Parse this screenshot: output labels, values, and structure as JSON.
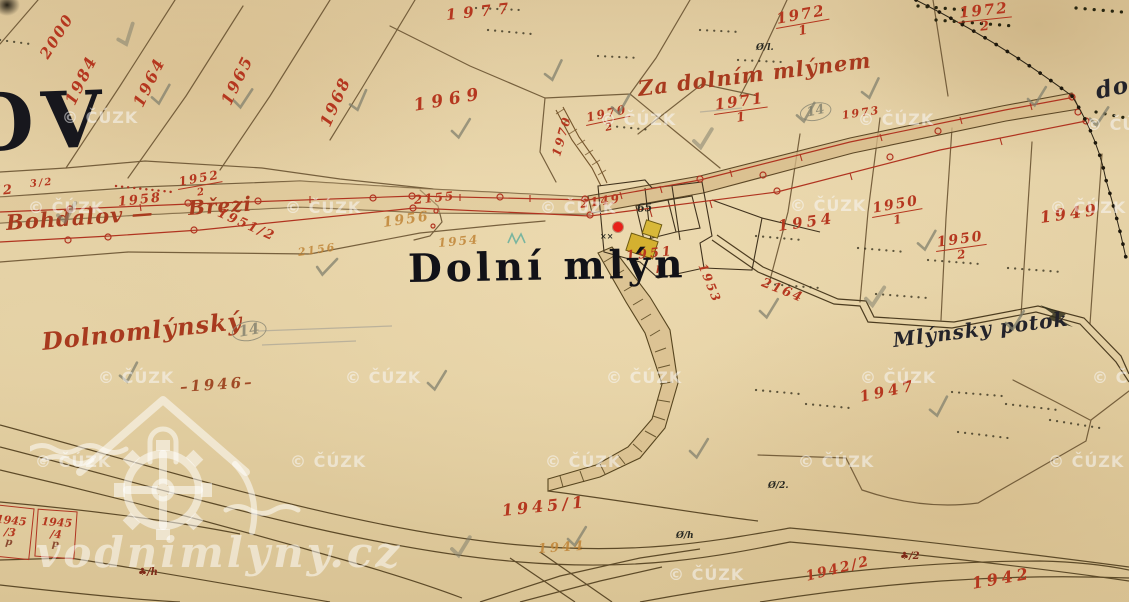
{
  "viewer": {
    "type": "historic-cadastral-map",
    "marker": {
      "x": 613,
      "y": 222,
      "color": "#e8211a"
    }
  },
  "watermark": {
    "text": "© ČÚZK",
    "site_text": "vodnimlyny.cz",
    "positions": [
      [
        62,
        108
      ],
      [
        600,
        110
      ],
      [
        858,
        110
      ],
      [
        1086,
        115
      ],
      [
        28,
        198
      ],
      [
        285,
        198
      ],
      [
        540,
        198
      ],
      [
        790,
        196
      ],
      [
        1050,
        198
      ],
      [
        98,
        368
      ],
      [
        345,
        368
      ],
      [
        606,
        368
      ],
      [
        860,
        368
      ],
      [
        1092,
        368
      ],
      [
        35,
        452
      ],
      [
        290,
        452
      ],
      [
        545,
        452
      ],
      [
        798,
        452
      ],
      [
        1048,
        452
      ],
      [
        668,
        565
      ]
    ]
  },
  "labels": [
    {
      "t": "2000",
      "x": 44,
      "y": 50,
      "r": -58,
      "c": "red",
      "s": 15
    },
    {
      "t": "1984",
      "x": 70,
      "y": 96,
      "r": -64,
      "c": "red",
      "s": 16
    },
    {
      "t": "1964",
      "x": 138,
      "y": 98,
      "r": -64,
      "c": "red",
      "s": 16
    },
    {
      "t": "1965",
      "x": 226,
      "y": 96,
      "r": -64,
      "c": "red",
      "s": 16
    },
    {
      "t": "1968",
      "x": 325,
      "y": 118,
      "r": -66,
      "c": "red",
      "s": 16
    },
    {
      "t": "1977",
      "x": 446,
      "y": 8,
      "r": -6,
      "c": "red",
      "s": 15,
      "sp": 7
    },
    {
      "t": "1969",
      "x": 414,
      "y": 98,
      "r": -10,
      "c": "red",
      "s": 17,
      "sp": 6
    },
    {
      "t": "1970",
      "x": 556,
      "y": 150,
      "r": -74,
      "c": "red",
      "s": 12
    },
    {
      "t": "1970",
      "d": "2",
      "x": 586,
      "y": 112,
      "r": -12,
      "c": "red",
      "s": 12
    },
    {
      "t": "1971",
      "d": "1",
      "x": 714,
      "y": 98,
      "r": -8,
      "c": "red",
      "s": 15
    },
    {
      "t": "1972",
      "d": "1",
      "x": 776,
      "y": 12,
      "r": -10,
      "c": "red",
      "s": 15
    },
    {
      "t": "1972",
      "d": "2",
      "x": 958,
      "y": 6,
      "r": -6,
      "c": "red",
      "s": 15
    },
    {
      "t": "1973",
      "x": 842,
      "y": 110,
      "r": -8,
      "c": "red",
      "s": 11
    },
    {
      "t": "2155",
      "x": 414,
      "y": 194,
      "r": -6,
      "c": "red",
      "s": 12
    },
    {
      "t": "1952",
      "d": "2",
      "x": 178,
      "y": 176,
      "r": -10,
      "c": "red",
      "s": 12
    },
    {
      "t": "1958",
      "x": 118,
      "y": 196,
      "r": -6,
      "c": "red",
      "s": 13
    },
    {
      "t": "1962",
      "x": -30,
      "y": 188,
      "r": -6,
      "c": "red",
      "s": 13
    },
    {
      "t": "3/2",
      "x": 30,
      "y": 180,
      "r": -6,
      "c": "red",
      "s": 10
    },
    {
      "t": "Bohdalov —",
      "x": 6,
      "y": 212,
      "r": -4,
      "c": "cursive",
      "s": 21
    },
    {
      "t": "Březi",
      "x": 188,
      "y": 198,
      "r": -4,
      "c": "cursive",
      "s": 20
    },
    {
      "t": "1951/2",
      "x": 218,
      "y": 206,
      "r": 24,
      "c": "red",
      "s": 13
    },
    {
      "t": "2149",
      "x": 580,
      "y": 198,
      "r": -8,
      "c": "red",
      "s": 12
    },
    {
      "t": "65",
      "x": 637,
      "y": 203,
      "r": -5,
      "c": "black-small",
      "s": 11
    },
    {
      "t": "××",
      "x": 600,
      "y": 232,
      "r": 0,
      "c": "black-small",
      "s": 8
    },
    {
      "t": "1956",
      "x": 383,
      "y": 216,
      "r": -8,
      "c": "orange",
      "s": 14
    },
    {
      "t": "1954",
      "x": 438,
      "y": 237,
      "r": -5,
      "c": "orange",
      "s": 12
    },
    {
      "t": "2156",
      "x": 298,
      "y": 247,
      "r": -8,
      "c": "orange",
      "s": 11
    },
    {
      "t": "1951",
      "x": 626,
      "y": 250,
      "r": -6,
      "c": "red",
      "s": 13,
      "sp": 3
    },
    {
      "t": "p",
      "x": 656,
      "y": 264,
      "r": 0,
      "c": "red",
      "s": 10
    },
    {
      "t": "1953",
      "x": 702,
      "y": 258,
      "r": 68,
      "c": "red",
      "s": 12
    },
    {
      "t": "2164",
      "x": 762,
      "y": 276,
      "r": 22,
      "c": "red",
      "s": 13
    },
    {
      "t": "1954",
      "x": 778,
      "y": 219,
      "r": -8,
      "c": "red",
      "s": 15,
      "sp": 4
    },
    {
      "t": "1950",
      "d": "1",
      "x": 872,
      "y": 202,
      "r": -10,
      "c": "red",
      "s": 14
    },
    {
      "t": "1950",
      "d": "2",
      "x": 936,
      "y": 236,
      "r": -8,
      "c": "red",
      "s": 14
    },
    {
      "t": "1949",
      "x": 1040,
      "y": 210,
      "r": -8,
      "c": "red",
      "s": 16,
      "sp": 4
    },
    {
      "t": "Za dolním mlýnem",
      "x": 638,
      "y": 78,
      "r": -7,
      "c": "cursive",
      "s": 21
    },
    {
      "t": "do",
      "x": 1096,
      "y": 80,
      "r": -12,
      "c": "black-italic",
      "s": 23
    },
    {
      "t": "Mlýnsky potok",
      "x": 893,
      "y": 330,
      "r": -7,
      "c": "black-italic",
      "s": 20
    },
    {
      "t": "OV",
      "x": -34,
      "y": 86,
      "r": -2,
      "c": "placename",
      "s": 78
    },
    {
      "t": "Dolní mlýn",
      "x": 408,
      "y": 250,
      "r": -1,
      "c": "title",
      "s": 39
    },
    {
      "t": "Dolnomlýnský",
      "x": 42,
      "y": 330,
      "r": -6,
      "c": "cursive",
      "s": 24
    },
    {
      "t": "14",
      "x": 232,
      "y": 324,
      "r": -10,
      "c": "pencil-circle",
      "s": 15
    },
    {
      "t": "14",
      "x": 800,
      "y": 106,
      "r": -12,
      "c": "pencil-circle",
      "s": 13
    },
    {
      "t": "–1946–",
      "x": 180,
      "y": 380,
      "r": -4,
      "c": "redbrown",
      "s": 15,
      "sp": 3
    },
    {
      "t": "1947",
      "x": 860,
      "y": 390,
      "r": -12,
      "c": "red",
      "s": 15,
      "sp": 4
    },
    {
      "t": "1945/1",
      "x": 502,
      "y": 503,
      "r": -6,
      "c": "red",
      "s": 16,
      "sp": 4
    },
    {
      "t": "1944",
      "x": 538,
      "y": 543,
      "r": -4,
      "c": "orange",
      "s": 13,
      "sp": 3
    },
    {
      "t": "1942/2",
      "x": 806,
      "y": 570,
      "r": -14,
      "c": "red",
      "s": 14,
      "sp": 2
    },
    {
      "t": "1942",
      "x": 972,
      "y": 576,
      "r": -10,
      "c": "red",
      "s": 16,
      "sp": 4
    },
    {
      "t": "Ø/2.",
      "x": 768,
      "y": 482,
      "r": 0,
      "c": "black-small",
      "s": 9
    },
    {
      "t": "Ø/h",
      "x": 676,
      "y": 532,
      "r": 0,
      "c": "black-small",
      "s": 9
    },
    {
      "t": "Ø/l.",
      "x": 756,
      "y": 44,
      "r": 0,
      "c": "black-small",
      "s": 9
    },
    {
      "t": "♣/2",
      "x": 900,
      "y": 552,
      "r": 0,
      "c": "darkred-small",
      "s": 10
    },
    {
      "t": "♣/h",
      "x": 138,
      "y": 568,
      "r": 0,
      "c": "darkred-small",
      "s": 10
    }
  ],
  "parcel_boxes": [
    {
      "num": "1945",
      "den": "3",
      "sub": "p",
      "x": -12,
      "y": 506,
      "w": 44,
      "h": 52,
      "r": 6
    },
    {
      "num": "1945",
      "den": "4",
      "sub": "p",
      "x": 36,
      "y": 510,
      "w": 40,
      "h": 48,
      "r": 4
    }
  ],
  "pencil_marks": [
    [
      116,
      24,
      -20
    ],
    [
      150,
      84,
      -8
    ],
    [
      232,
      88,
      -4
    ],
    [
      450,
      118,
      -6
    ],
    [
      543,
      60,
      -12
    ],
    [
      692,
      128,
      -6
    ],
    [
      795,
      102,
      -8
    ],
    [
      860,
      78,
      -12
    ],
    [
      1026,
      86,
      -6
    ],
    [
      1088,
      106,
      -4
    ],
    [
      56,
      202,
      -8
    ],
    [
      315,
      256,
      6
    ],
    [
      758,
      298,
      -6
    ],
    [
      916,
      230,
      -8
    ],
    [
      1004,
      310,
      -6
    ],
    [
      864,
      286,
      -4
    ],
    [
      118,
      362,
      -10
    ],
    [
      426,
      370,
      -6
    ],
    [
      928,
      396,
      -10
    ],
    [
      566,
      526,
      -6
    ],
    [
      450,
      536,
      -6
    ],
    [
      688,
      438,
      -6
    ],
    [
      348,
      90,
      -14
    ],
    [
      610,
      94,
      -8
    ]
  ]
}
